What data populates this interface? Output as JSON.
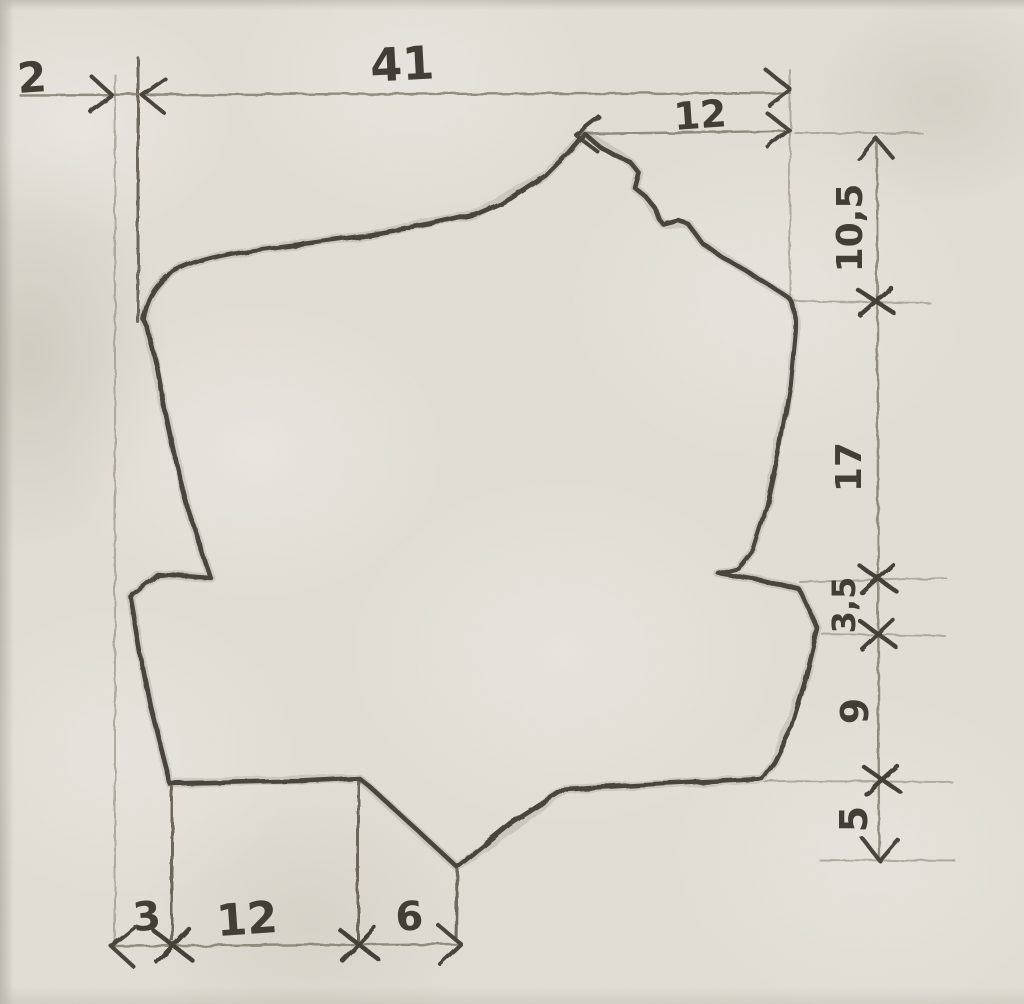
{
  "sketch": {
    "description": "hand-drawn pencil dimension sketch of an irregular part outline",
    "unit_labels": {
      "top_offset": "2",
      "top_total": "41",
      "top_right": "12",
      "right_top": "10,5",
      "right_upper_mid": "17",
      "right_lower_mid": "3,5",
      "right_lower": "9",
      "right_bottom": "5",
      "bottom_left": "3",
      "bottom_middle": "12",
      "bottom_right": "6"
    },
    "colors": {
      "paper": "#e2ded5",
      "pencil_dark": "#49443c",
      "pencil_light": "#9a9386"
    }
  }
}
